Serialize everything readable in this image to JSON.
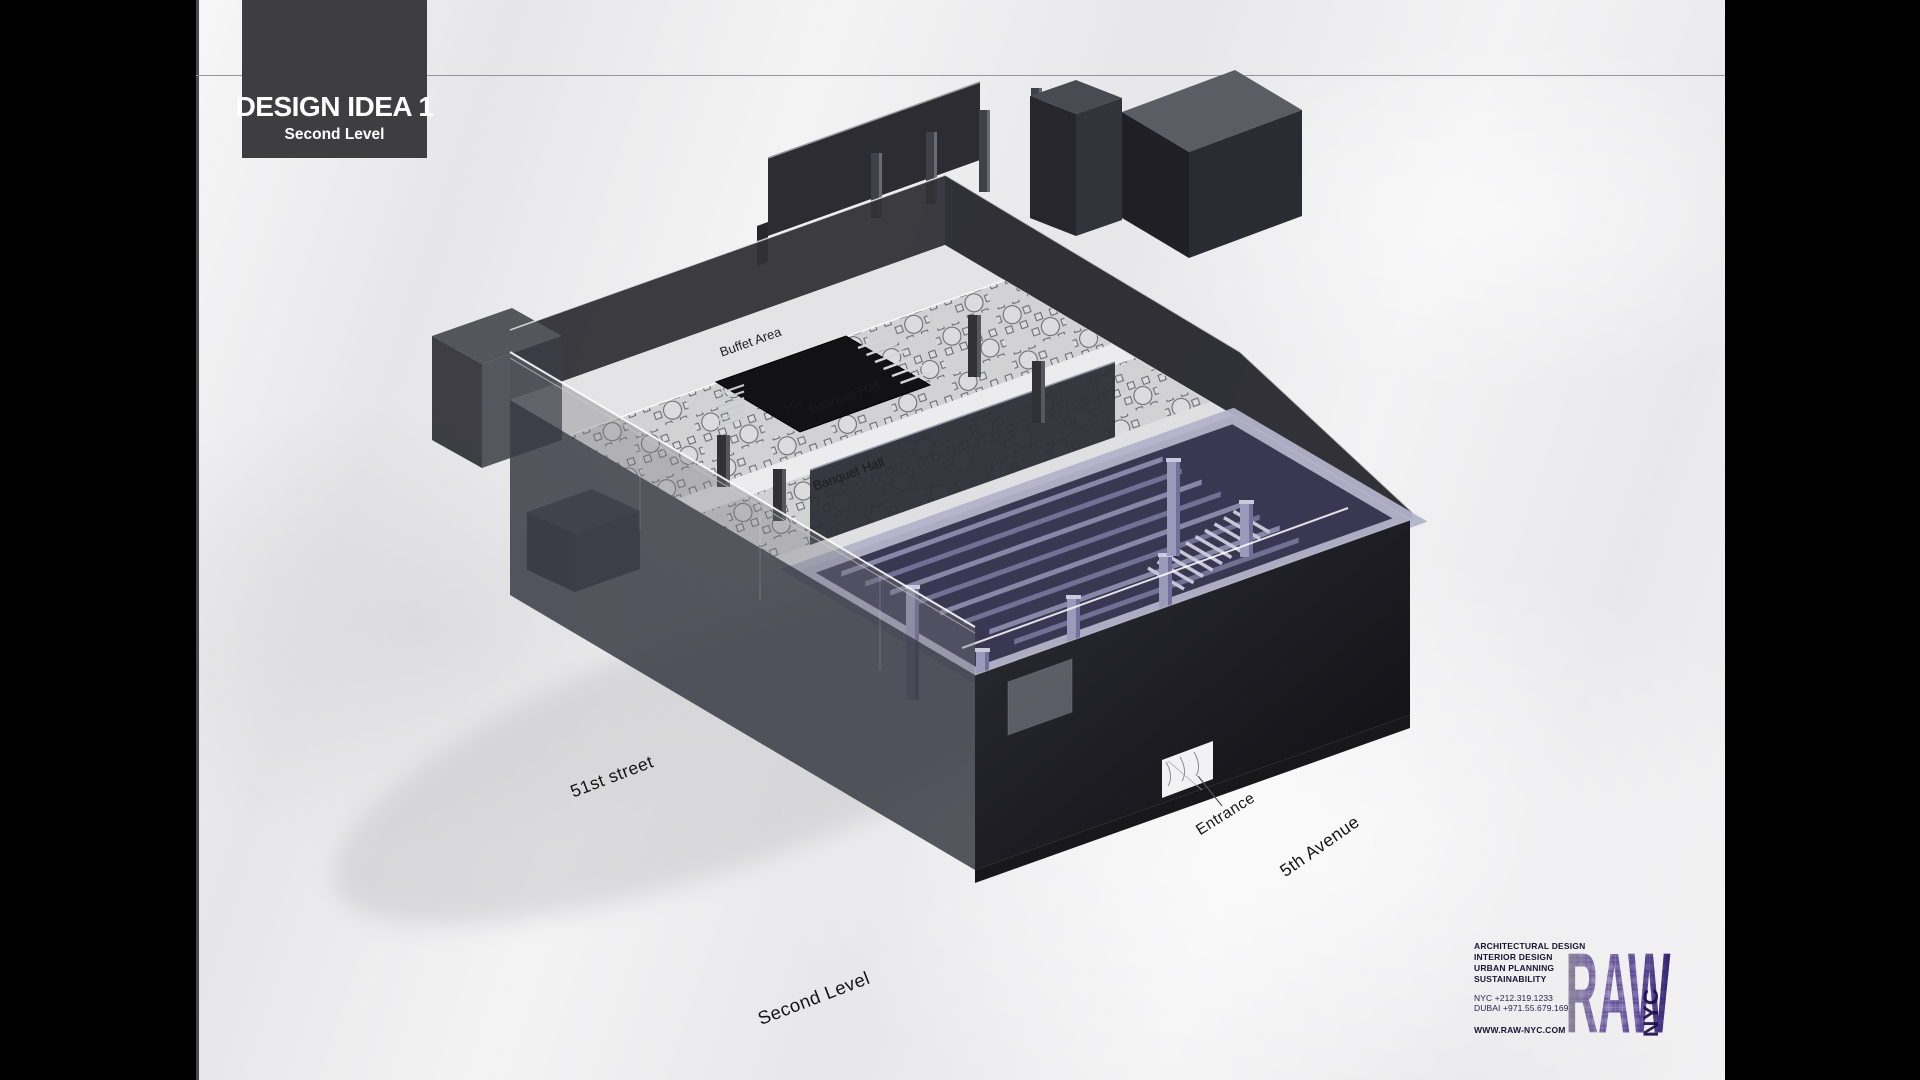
{
  "title_block": {
    "title": "DESIGN IDEA 1",
    "subtitle": "Second Level"
  },
  "model_labels": {
    "buffet_area": "Buffet Area",
    "stair": "Stair",
    "banquet_hall_upper": "Banquet Hall",
    "banquet_hall_lower": "Banquet Hall"
  },
  "annotations": {
    "street_left": "51st street",
    "level_caption": "Second Level",
    "entrance": "Entrance",
    "avenue": "5th Avenue"
  },
  "logo_block": {
    "services": [
      "ARCHITECTURAL DESIGN",
      "INTERIOR DESIGN",
      "URBAN PLANNING",
      "SUSTAINABILITY"
    ],
    "phone_nyc": "NYC +212.319.1233",
    "phone_dubai": "DUBAI +971.55.679.1691",
    "website": "WWW.RAW-NYC.COM",
    "logo_text": "RAW",
    "logo_sub": "NYC"
  },
  "colors": {
    "brand_purple": "#5b4690",
    "brand_purple_dark": "#2c1a66",
    "title_box_bg": "#3e3e42",
    "paper": "#ededee",
    "wall_dark": "#2a2a30",
    "floor_light": "#dadadc",
    "atrium_navy": "#383852",
    "atrium_lavender": "#9a9aba",
    "letterbox": "#000000"
  }
}
